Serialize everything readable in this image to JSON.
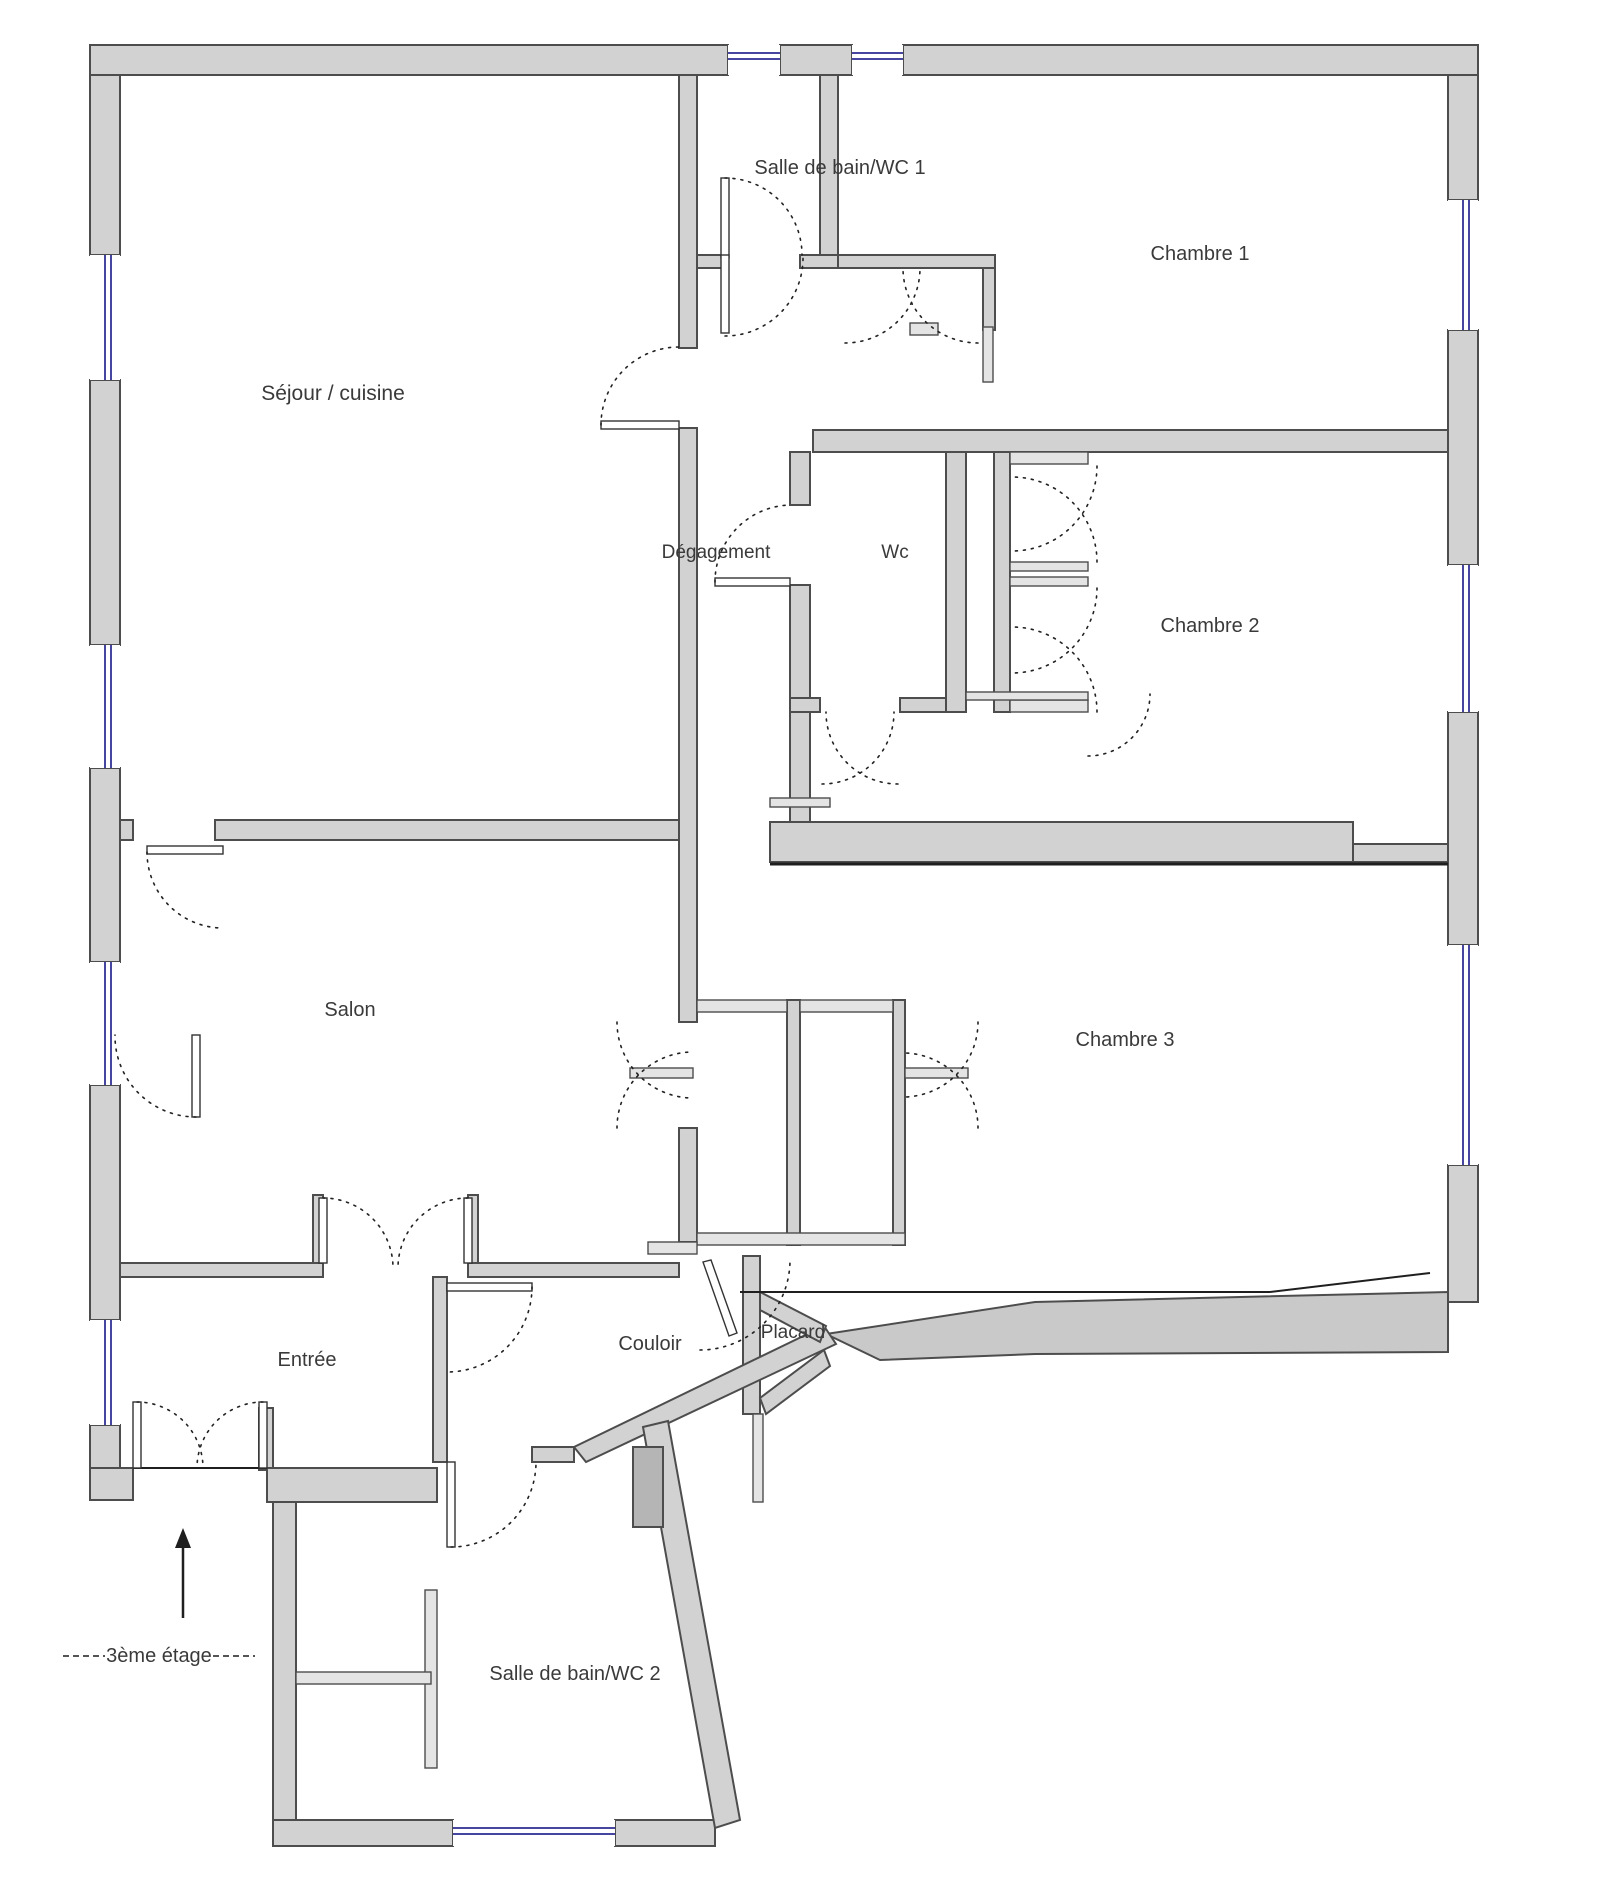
{
  "title": "floor-plan-3eme-etage",
  "colors": {
    "wall_fill": "#d2d2d2",
    "wall_stroke": "#4d4d4d",
    "thin_fill": "#e4e4e4",
    "window_color": "#4646a0",
    "landing_fill": "#c9c9c9",
    "shaft_fill": "#b5b5b5",
    "door_color": "#222222",
    "text_color": "#3a3a3a",
    "background": "#ffffff"
  },
  "floor_note": {
    "label": "3ème étage",
    "x": 159,
    "y": 1662,
    "dash_left": [
      63,
      1656,
      105,
      1656
    ],
    "dash_right": [
      213,
      1656,
      255,
      1656
    ],
    "arrow": {
      "x": 183,
      "y_top": 1538,
      "y_bottom": 1618
    }
  },
  "rooms": [
    {
      "id": "sejour-cuisine",
      "label": "Séjour / cuisine",
      "x": 333,
      "y": 400,
      "size": 21
    },
    {
      "id": "salle-de-bain-wc-1",
      "label": "Salle de bain/WC 1",
      "x": 840,
      "y": 174,
      "size": 20
    },
    {
      "id": "chambre-1",
      "label": "Chambre 1",
      "x": 1200,
      "y": 260,
      "size": 20
    },
    {
      "id": "degagement",
      "label": "Dégagement",
      "x": 716,
      "y": 558,
      "size": 19
    },
    {
      "id": "wc",
      "label": "Wc",
      "x": 895,
      "y": 558,
      "size": 19
    },
    {
      "id": "chambre-2",
      "label": "Chambre 2",
      "x": 1210,
      "y": 632,
      "size": 20
    },
    {
      "id": "salon",
      "label": "Salon",
      "x": 350,
      "y": 1016,
      "size": 20
    },
    {
      "id": "chambre-3",
      "label": "Chambre 3",
      "x": 1125,
      "y": 1046,
      "size": 20
    },
    {
      "id": "entree",
      "label": "Entrée",
      "x": 307,
      "y": 1366,
      "size": 20
    },
    {
      "id": "couloir",
      "label": "Couloir",
      "x": 650,
      "y": 1350,
      "size": 20
    },
    {
      "id": "placard",
      "label": "Placard",
      "x": 793,
      "y": 1338,
      "size": 19
    },
    {
      "id": "salle-de-bain-wc-2",
      "label": "Salle de bain/WC 2",
      "x": 575,
      "y": 1680,
      "size": 20
    }
  ],
  "plan": {
    "walls": [
      [
        90,
        45,
        638,
        30
      ],
      [
        780,
        45,
        72,
        30
      ],
      [
        903,
        45,
        575,
        30
      ],
      [
        90,
        75,
        30,
        180
      ],
      [
        90,
        380,
        30,
        265
      ],
      [
        90,
        768,
        30,
        194
      ],
      [
        90,
        1085,
        30,
        235
      ],
      [
        90,
        1425,
        30,
        75
      ],
      [
        1448,
        75,
        30,
        125
      ],
      [
        1448,
        330,
        30,
        235
      ],
      [
        1448,
        712,
        30,
        233
      ],
      [
        1448,
        1165,
        30,
        137
      ],
      [
        90,
        1468,
        43,
        32
      ],
      [
        259,
        1408,
        14,
        62
      ],
      [
        267,
        1468,
        170,
        34
      ],
      [
        273,
        1502,
        23,
        330
      ],
      [
        273,
        1820,
        180,
        26
      ],
      [
        615,
        1820,
        100,
        26
      ],
      [
        770,
        822,
        583,
        40
      ],
      [
        1353,
        844,
        95,
        18
      ],
      [
        679,
        75,
        18,
        273
      ],
      [
        679,
        428,
        18,
        594
      ],
      [
        679,
        1128,
        18,
        114
      ],
      [
        820,
        75,
        18,
        180
      ],
      [
        697,
        255,
        26,
        13
      ],
      [
        800,
        255,
        38,
        13
      ],
      [
        838,
        255,
        157,
        13
      ],
      [
        983,
        268,
        12,
        62
      ],
      [
        813,
        430,
        635,
        22
      ],
      [
        790,
        452,
        20,
        53
      ],
      [
        790,
        585,
        20,
        237
      ],
      [
        790,
        698,
        30,
        14
      ],
      [
        900,
        698,
        63,
        14
      ],
      [
        946,
        452,
        20,
        260
      ],
      [
        994,
        452,
        16,
        260
      ],
      [
        120,
        820,
        13,
        20
      ],
      [
        215,
        820,
        464,
        20
      ],
      [
        120,
        1263,
        203,
        14
      ],
      [
        468,
        1263,
        211,
        14
      ],
      [
        313,
        1195,
        10,
        68
      ],
      [
        468,
        1195,
        10,
        68
      ],
      [
        433,
        1277,
        14,
        185
      ],
      [
        532,
        1447,
        42,
        15
      ],
      [
        743,
        1256,
        17,
        158
      ],
      [
        787,
        1000,
        13,
        245
      ],
      [
        893,
        1000,
        12,
        245
      ]
    ],
    "thin_walls": [
      [
        425,
        1590,
        12,
        178
      ],
      [
        296,
        1672,
        135,
        12
      ],
      [
        697,
        1000,
        90,
        12
      ],
      [
        800,
        1000,
        93,
        12
      ],
      [
        697,
        1233,
        208,
        12
      ],
      [
        630,
        1068,
        63,
        10
      ],
      [
        905,
        1068,
        63,
        10
      ],
      [
        1010,
        452,
        78,
        12
      ],
      [
        1010,
        562,
        78,
        9
      ],
      [
        1010,
        577,
        78,
        9
      ],
      [
        1010,
        700,
        78,
        12
      ],
      [
        966,
        692,
        122,
        8
      ],
      [
        770,
        798,
        60,
        9
      ],
      [
        648,
        1242,
        49,
        12
      ],
      [
        753,
        1414,
        10,
        88
      ],
      [
        910,
        323,
        28,
        12
      ],
      [
        983,
        327,
        10,
        55
      ]
    ],
    "polygons": [
      {
        "name": "stair-landing",
        "fill": "landing",
        "points": "826,1334 1035,1302 1448,1292 1448,1352 1035,1354 880,1360"
      },
      {
        "name": "diagonal-wall-upper",
        "fill": "wall",
        "points": "574,1447 824,1326 836,1344 586,1462"
      },
      {
        "name": "diagonal-wall-lower",
        "fill": "wall",
        "points": "643,1427 668,1421 740,1820 715,1828"
      },
      {
        "name": "placard-slant-top",
        "fill": "wall",
        "points": "760,1292 826,1326 820,1342 760,1310"
      },
      {
        "name": "placard-slant-bottom",
        "fill": "wall",
        "points": "760,1398 824,1350 830,1366 766,1414"
      },
      {
        "name": "duct-shaft",
        "fill": "shaft",
        "points": "633,1447 663,1447 663,1527 633,1527"
      }
    ],
    "windows": [
      {
        "x": 728,
        "y": 45,
        "w": 52,
        "h": 30,
        "o": "h"
      },
      {
        "x": 852,
        "y": 45,
        "w": 51,
        "h": 30,
        "o": "h"
      },
      {
        "x": 90,
        "y": 255,
        "w": 30,
        "h": 125,
        "o": "v"
      },
      {
        "x": 90,
        "y": 645,
        "w": 30,
        "h": 123,
        "o": "v"
      },
      {
        "x": 90,
        "y": 962,
        "w": 30,
        "h": 123,
        "o": "v"
      },
      {
        "x": 90,
        "y": 1320,
        "w": 30,
        "h": 105,
        "o": "v"
      },
      {
        "x": 1448,
        "y": 200,
        "w": 30,
        "h": 130,
        "o": "v"
      },
      {
        "x": 1448,
        "y": 565,
        "w": 30,
        "h": 147,
        "o": "v"
      },
      {
        "x": 1448,
        "y": 945,
        "w": 30,
        "h": 220,
        "o": "v"
      },
      {
        "x": 453,
        "y": 1820,
        "w": 162,
        "h": 26,
        "o": "h"
      }
    ],
    "lines": [
      [
        770,
        864,
        1448,
        864,
        3
      ],
      [
        740,
        1292,
        1270,
        1292,
        2
      ],
      [
        1270,
        1292,
        1430,
        1273,
        2
      ],
      [
        133,
        1468,
        267,
        1468,
        2
      ]
    ],
    "leaves": [
      [
        601,
        421,
        78,
        8
      ],
      [
        721,
        178,
        8,
        80
      ],
      [
        721,
        255,
        8,
        78
      ],
      [
        715,
        578,
        75,
        8
      ],
      [
        147,
        846,
        76,
        8
      ],
      [
        319,
        1198,
        8,
        65
      ],
      [
        464,
        1198,
        8,
        65
      ],
      [
        447,
        1283,
        85,
        8
      ],
      [
        447,
        1462,
        8,
        85
      ],
      [
        133,
        1402,
        8,
        66
      ],
      [
        259,
        1402,
        8,
        66
      ],
      [
        192,
        1035,
        8,
        82
      ]
    ],
    "leaf_polygons": [
      {
        "name": "door-leaf-placard",
        "points": "703,1262 711,1260 737,1333 729,1336"
      }
    ],
    "arcs": [
      [
        601,
        425,
        78,
        1,
        679,
        347
      ],
      [
        725,
        178,
        77,
        1,
        802,
        255
      ],
      [
        725,
        336,
        78,
        0,
        803,
        258
      ],
      [
        715,
        582,
        77,
        1,
        790,
        505
      ],
      [
        822,
        784,
        72,
        0,
        894,
        712
      ],
      [
        898,
        784,
        72,
        1,
        826,
        712
      ],
      [
        1097,
        466,
        85,
        1,
        1012,
        551
      ],
      [
        1097,
        562,
        85,
        0,
        1012,
        477
      ],
      [
        1097,
        588,
        85,
        1,
        1012,
        673
      ],
      [
        1097,
        712,
        85,
        0,
        1012,
        627
      ],
      [
        1088,
        756,
        62,
        0,
        1150,
        694
      ],
      [
        845,
        343,
        75,
        0,
        920,
        268
      ],
      [
        978,
        343,
        75,
        1,
        903,
        268
      ],
      [
        147,
        852,
        76,
        0,
        223,
        928
      ],
      [
        323,
        1198,
        70,
        1,
        393,
        1268
      ],
      [
        468,
        1198,
        70,
        0,
        398,
        1268
      ],
      [
        532,
        1287,
        85,
        1,
        447,
        1372
      ],
      [
        451,
        1547,
        85,
        0,
        536,
        1462
      ],
      [
        137,
        1402,
        66,
        1,
        203,
        1468
      ],
      [
        263,
        1402,
        66,
        0,
        197,
        1468
      ],
      [
        700,
        1350,
        90,
        0,
        790,
        1260
      ],
      [
        617,
        1022,
        76,
        0,
        693,
        1098
      ],
      [
        617,
        1128,
        76,
        1,
        693,
        1052
      ],
      [
        978,
        1022,
        75,
        1,
        903,
        1097
      ],
      [
        978,
        1128,
        75,
        0,
        903,
        1053
      ],
      [
        196,
        1117,
        81,
        1,
        115,
        1035
      ]
    ]
  }
}
